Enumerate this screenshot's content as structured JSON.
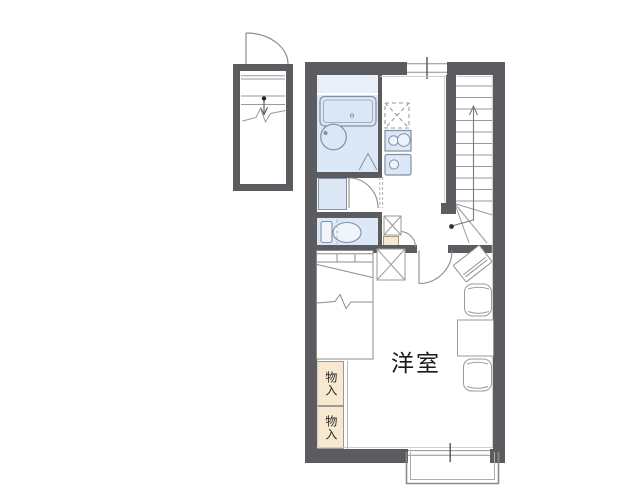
{
  "floorplan": {
    "labels": {
      "western_room": "洋室",
      "storage_upper": "物入",
      "storage_lower": "物入"
    },
    "colors": {
      "wall": "#5b5b60",
      "wet_room_blue": "#dce8f6",
      "wet_room_blue_light": "#e9eff9",
      "storage_beige": "#f7e9cf",
      "furniture_line": "#8c8c8c",
      "fixture_line": "#7f90a4",
      "text": "#1a1a1a"
    },
    "fixture_symbols": [
      "entrance-porch",
      "entry-door",
      "staircase",
      "stair-direction-arrow",
      "bathroom",
      "bathtub",
      "washbasin",
      "folding-bath-door",
      "vanity-unit",
      "toilet",
      "refrigerator-space",
      "gas-stove",
      "kitchen-sink",
      "washing-machine-space",
      "bed",
      "storage",
      "tv",
      "table",
      "chair",
      "balcony",
      "sliding-window"
    ]
  }
}
